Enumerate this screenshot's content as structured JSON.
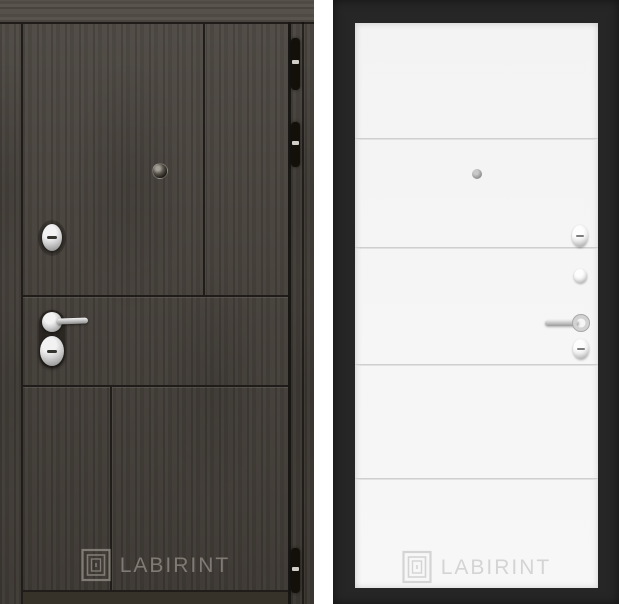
{
  "page": {
    "background": "#ffffff"
  },
  "brand": "LABIRINT",
  "left_door": {
    "watermark_text": "LABIRINT",
    "colors": {
      "wood_base": "#443f39",
      "top_rail": "#544e48",
      "groove": "#1f1c19",
      "bottom_strip": "#363229",
      "hinge": "#121009",
      "hinge_band": "#cfcdc6",
      "chrome_light": "#f2f2f2",
      "chrome_dark": "#8a8a8a",
      "watermark": "#8b867f"
    },
    "icons": [
      "hinge-icon",
      "peephole-icon",
      "keyhole-escutcheon-icon",
      "lever-handle-icon",
      "cylinder-lock-icon",
      "labirint-logo-icon"
    ]
  },
  "right_door": {
    "watermark_text": "LABIRINT",
    "colors": {
      "frame": "#262626",
      "panel": "#f5f5f5",
      "panel_line": "#d4d4d4",
      "chrome_light": "#ececec",
      "chrome_dark": "#9e9e9e",
      "watermark": "#d4d4d4"
    },
    "icons": [
      "peephole-icon",
      "turn-knob-icon",
      "night-latch-knob-icon",
      "lever-handle-icon",
      "keyhole-escutcheon-icon",
      "labirint-logo-icon"
    ]
  }
}
